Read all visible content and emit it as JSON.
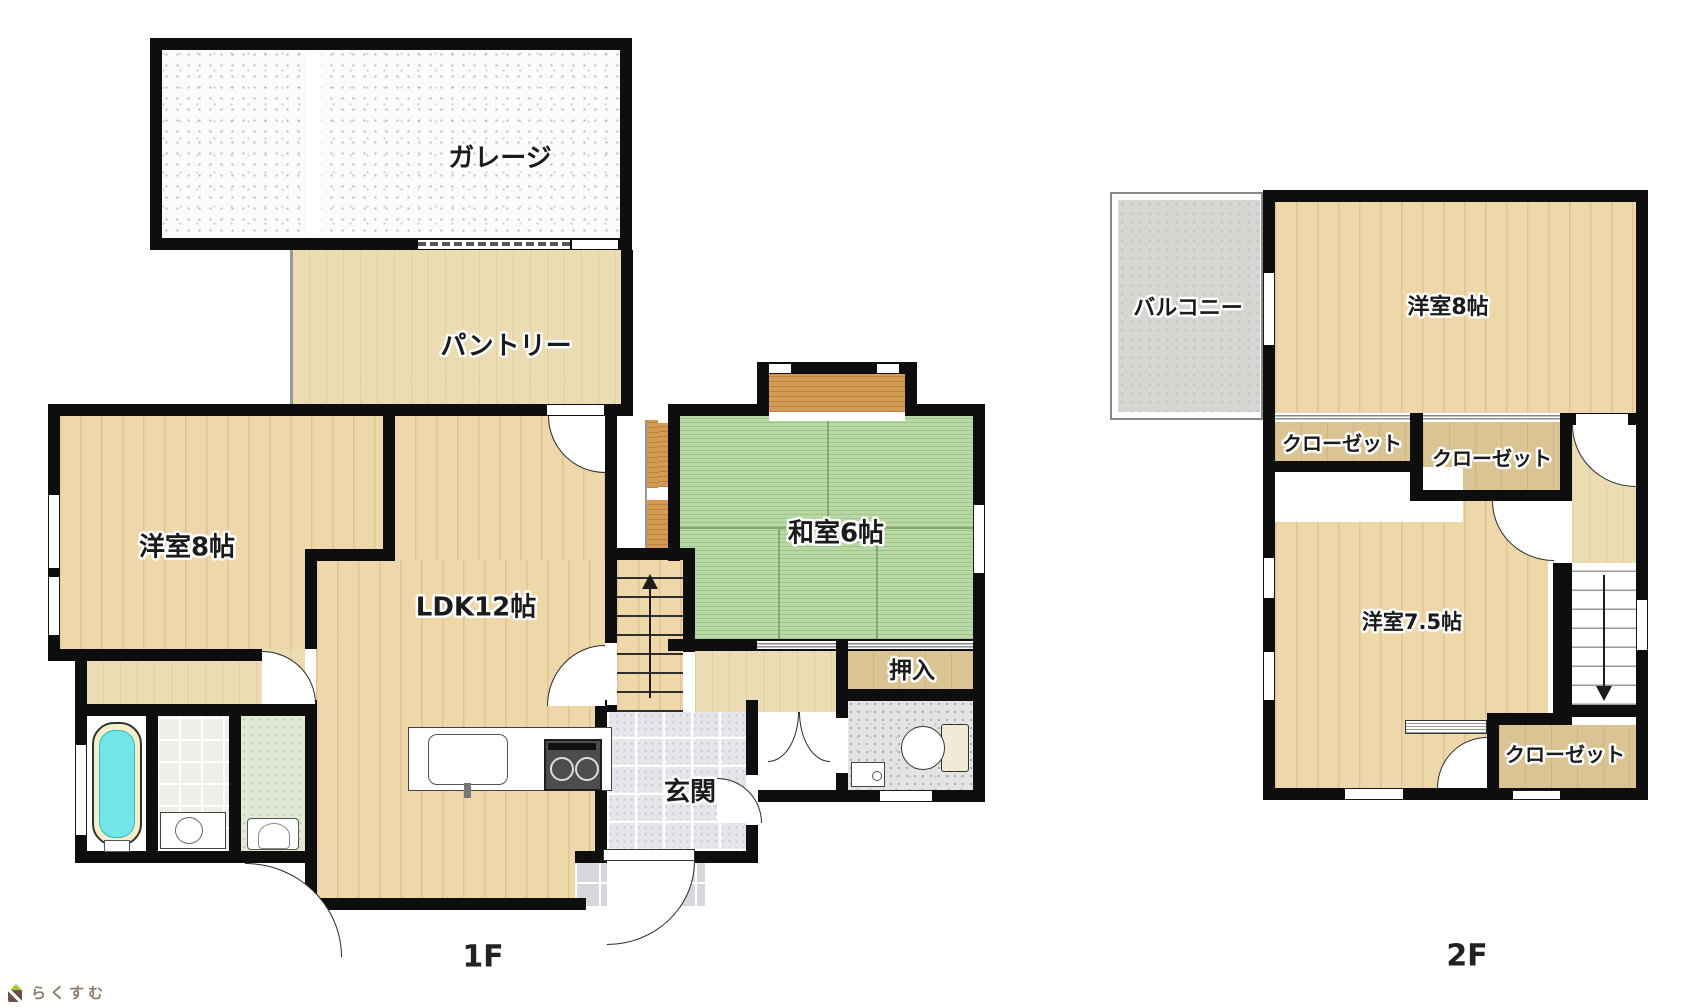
{
  "floor1": {
    "floor_label": "1F",
    "garage": "ガレージ",
    "pantry": "パントリー",
    "bedroom8": "洋室8帖",
    "ldk": "LDK12帖",
    "washitsu": "和室6帖",
    "oshiire": "押入",
    "genkan": "玄関"
  },
  "floor2": {
    "floor_label": "2F",
    "balcony": "バルコニー",
    "bedroom8": "洋室8帖",
    "closet_a": "クローゼット",
    "closet_b": "クローゼット",
    "bedroom75": "洋室7.5帖",
    "closet_c": "クローゼット"
  },
  "logo": {
    "text": "らくすむ"
  },
  "colors": {
    "wall": "#0e0e0e",
    "wood_floor": "#eed7a9",
    "closet_wood": "#dbc493",
    "tatami_green": "#b9d9a4",
    "bathtub_cyan": "#72e5e7",
    "entry_tile_gray": "#e6e6ea",
    "balcony_gray": "#d6d6d3",
    "logo_roof_green": "#a9c63e",
    "logo_brown": "#6b5144"
  }
}
